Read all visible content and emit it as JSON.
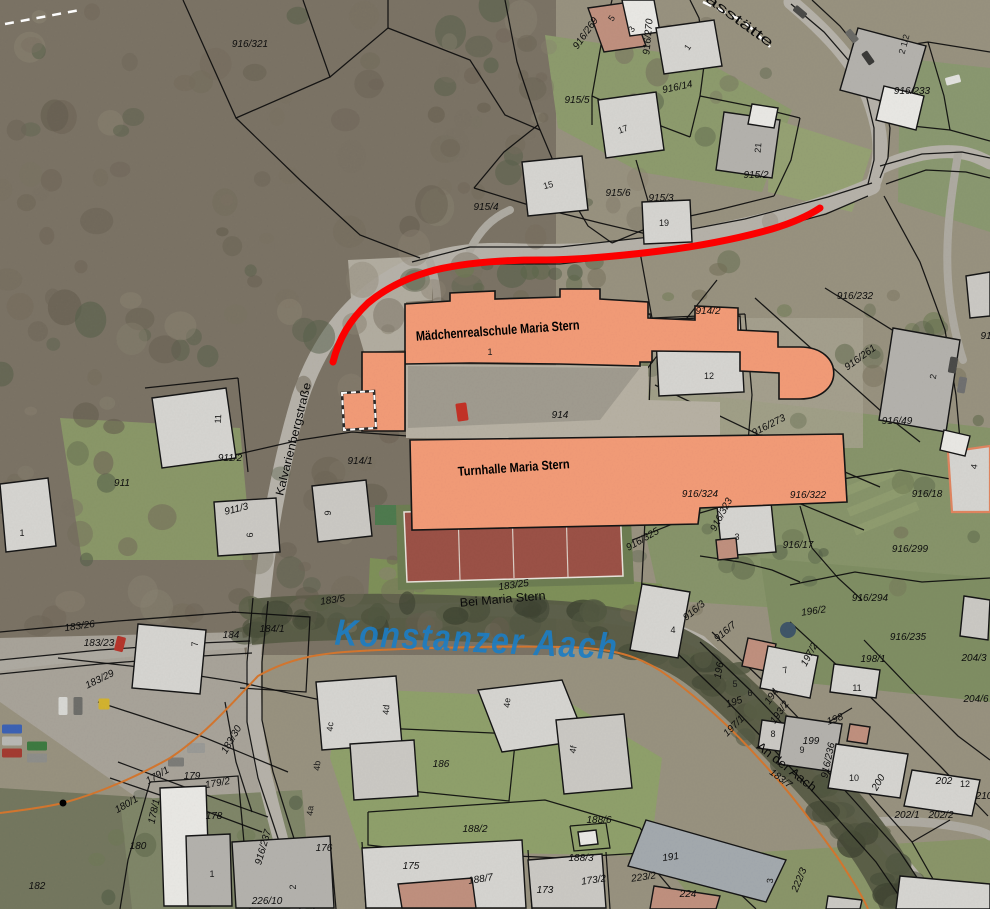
{
  "map": {
    "school_label": "Mädchenrealschule Maria Stern",
    "turnhalle_label": "Turnhalle Maria Stern",
    "water_label": "Konstanzer Aach",
    "colors": {
      "highlight": "#F29B77",
      "route": "#FE0000",
      "water_text": "#1D7EC5",
      "orange_boundary": "#D4762E"
    },
    "street_labels": [
      {
        "t": "Kalvarienbergstraße",
        "x": 297,
        "y": 440,
        "r": -76,
        "s": 11.5,
        "len": 116
      },
      {
        "t": "Bei Maria Stern",
        "x": 503,
        "y": 603,
        "r": -5,
        "s": 12,
        "len": 86
      },
      {
        "t": "An der Aach",
        "x": 784,
        "y": 770,
        "r": 38,
        "s": 12.5,
        "len": 72
      },
      {
        "t": "asstätte",
        "x": 737,
        "y": 24,
        "r": 36,
        "s": 13.5,
        "len": 80
      }
    ],
    "parcel_labels": [
      {
        "t": "916/321",
        "x": 250,
        "y": 47
      },
      {
        "t": "916/269",
        "x": 588,
        "y": 35,
        "r": -55
      },
      {
        "t": "916/270",
        "x": 651,
        "y": 37,
        "r": -85
      },
      {
        "t": "916/14",
        "x": 678,
        "y": 90,
        "r": -12
      },
      {
        "t": "915/5",
        "x": 577,
        "y": 103
      },
      {
        "t": "915/4",
        "x": 486,
        "y": 210
      },
      {
        "t": "915/6",
        "x": 618,
        "y": 196
      },
      {
        "t": "915/3",
        "x": 661,
        "y": 201
      },
      {
        "t": "915/2",
        "x": 756,
        "y": 178
      },
      {
        "t": "916/233",
        "x": 912,
        "y": 94
      },
      {
        "t": "916/232",
        "x": 855,
        "y": 299
      },
      {
        "t": "914/2",
        "x": 708,
        "y": 314
      },
      {
        "t": "916/261",
        "x": 862,
        "y": 360,
        "r": -36
      },
      {
        "t": "916/273",
        "x": 770,
        "y": 428,
        "r": -27
      },
      {
        "t": "916/49",
        "x": 897,
        "y": 424
      },
      {
        "t": "914",
        "x": 560,
        "y": 418
      },
      {
        "t": "914/1",
        "x": 360,
        "y": 464
      },
      {
        "t": "911/2",
        "x": 230,
        "y": 461
      },
      {
        "t": "911",
        "x": 122,
        "y": 486
      },
      {
        "t": "911/3",
        "x": 237,
        "y": 512,
        "r": -14
      },
      {
        "t": "916/324",
        "x": 700,
        "y": 497
      },
      {
        "t": "916/323",
        "x": 724,
        "y": 516,
        "r": -62
      },
      {
        "t": "916/322",
        "x": 808,
        "y": 498
      },
      {
        "t": "916/325",
        "x": 644,
        "y": 542,
        "r": -30
      },
      {
        "t": "916/17",
        "x": 798,
        "y": 548
      },
      {
        "t": "916/18",
        "x": 927,
        "y": 497
      },
      {
        "t": "916/299",
        "x": 910,
        "y": 552
      },
      {
        "t": "916/3",
        "x": 696,
        "y": 613,
        "r": -40
      },
      {
        "t": "916/7",
        "x": 727,
        "y": 634,
        "r": -40
      },
      {
        "t": "196/2",
        "x": 814,
        "y": 614,
        "r": -8
      },
      {
        "t": "916/294",
        "x": 870,
        "y": 601
      },
      {
        "t": "916/235",
        "x": 908,
        "y": 640
      },
      {
        "t": "198/1",
        "x": 873,
        "y": 662
      },
      {
        "t": "204/3",
        "x": 974,
        "y": 661
      },
      {
        "t": "204/6",
        "x": 976,
        "y": 702
      },
      {
        "t": "197/2",
        "x": 812,
        "y": 656,
        "r": -62
      },
      {
        "t": "196",
        "x": 722,
        "y": 671,
        "r": -80
      },
      {
        "t": "195",
        "x": 735,
        "y": 705,
        "r": -18
      },
      {
        "t": "194",
        "x": 774,
        "y": 698,
        "r": -55
      },
      {
        "t": "193/2",
        "x": 782,
        "y": 714,
        "r": -55
      },
      {
        "t": "197/1",
        "x": 736,
        "y": 728,
        "r": -45
      },
      {
        "t": "183/7",
        "x": 779,
        "y": 781,
        "r": 36
      },
      {
        "t": "198",
        "x": 836,
        "y": 722,
        "r": -20
      },
      {
        "t": "199",
        "x": 811,
        "y": 744
      },
      {
        "t": "916/236",
        "x": 831,
        "y": 761,
        "r": -78
      },
      {
        "t": "200",
        "x": 881,
        "y": 784,
        "r": -60
      },
      {
        "t": "202",
        "x": 944,
        "y": 784
      },
      {
        "t": "210",
        "x": 984,
        "y": 799
      },
      {
        "t": "202/1",
        "x": 907,
        "y": 818
      },
      {
        "t": "202/2",
        "x": 941,
        "y": 818
      },
      {
        "t": "183/25",
        "x": 514,
        "y": 588,
        "r": -8
      },
      {
        "t": "183/5",
        "x": 333,
        "y": 603,
        "r": -8
      },
      {
        "t": "183/26",
        "x": 80,
        "y": 629,
        "r": -8
      },
      {
        "t": "183/23",
        "x": 99,
        "y": 646
      },
      {
        "t": "183/29",
        "x": 101,
        "y": 682,
        "r": -26
      },
      {
        "t": "184",
        "x": 231,
        "y": 638
      },
      {
        "t": "184/1",
        "x": 272,
        "y": 632
      },
      {
        "t": "183/30",
        "x": 234,
        "y": 741,
        "r": -60
      },
      {
        "t": "179/1",
        "x": 159,
        "y": 778,
        "r": -30
      },
      {
        "t": "179",
        "x": 192,
        "y": 779
      },
      {
        "t": "179/2",
        "x": 218,
        "y": 786,
        "r": -10
      },
      {
        "t": "180/1",
        "x": 128,
        "y": 807,
        "r": -30
      },
      {
        "t": "178/1",
        "x": 157,
        "y": 812,
        "r": -78
      },
      {
        "t": "178",
        "x": 214,
        "y": 819
      },
      {
        "t": "180",
        "x": 138,
        "y": 849
      },
      {
        "t": "182",
        "x": 37,
        "y": 889
      },
      {
        "t": "916/237",
        "x": 266,
        "y": 848,
        "r": -74
      },
      {
        "t": "226/10",
        "x": 267,
        "y": 904
      },
      {
        "t": "176",
        "x": 324,
        "y": 851
      },
      {
        "t": "175",
        "x": 411,
        "y": 869
      },
      {
        "t": "186",
        "x": 441,
        "y": 767
      },
      {
        "t": "188/2",
        "x": 475,
        "y": 832
      },
      {
        "t": "188/6",
        "x": 599,
        "y": 823
      },
      {
        "t": "188/3",
        "x": 581,
        "y": 861
      },
      {
        "t": "188/7",
        "x": 481,
        "y": 882,
        "r": -9
      },
      {
        "t": "173",
        "x": 545,
        "y": 893
      },
      {
        "t": "173/2",
        "x": 594,
        "y": 883,
        "r": -8
      },
      {
        "t": "223/2",
        "x": 644,
        "y": 880,
        "r": -8
      },
      {
        "t": "191",
        "x": 671,
        "y": 860,
        "r": -8
      },
      {
        "t": "224",
        "x": 688,
        "y": 897
      },
      {
        "t": "222/3",
        "x": 802,
        "y": 881,
        "r": -68
      },
      {
        "t": "91",
        "x": 986,
        "y": 339
      }
    ],
    "house_numbers": [
      {
        "t": "5",
        "x": 614,
        "y": 20,
        "r": -55
      },
      {
        "t": "3",
        "x": 634,
        "y": 31,
        "r": -55
      },
      {
        "t": "1",
        "x": 690,
        "y": 49,
        "r": -55
      },
      {
        "t": "17",
        "x": 624,
        "y": 132,
        "r": -20
      },
      {
        "t": "15",
        "x": 549,
        "y": 188,
        "r": -15
      },
      {
        "t": "21",
        "x": 761,
        "y": 148,
        "r": -85
      },
      {
        "t": "19",
        "x": 664,
        "y": 226
      },
      {
        "t": "2 1/2",
        "x": 907,
        "y": 45,
        "r": -75
      },
      {
        "t": "12",
        "x": 709,
        "y": 379
      },
      {
        "t": "2",
        "x": 936,
        "y": 377,
        "r": -80
      },
      {
        "t": "1",
        "x": 490,
        "y": 355
      },
      {
        "t": "11",
        "x": 221,
        "y": 419,
        "r": -87
      },
      {
        "t": "9",
        "x": 331,
        "y": 513,
        "r": -90
      },
      {
        "t": "6",
        "x": 253,
        "y": 535,
        "r": -90
      },
      {
        "t": "1",
        "x": 22,
        "y": 536
      },
      {
        "t": "3",
        "x": 737,
        "y": 540
      },
      {
        "t": "4",
        "x": 977,
        "y": 467,
        "r": -80
      },
      {
        "t": "4",
        "x": 673,
        "y": 633
      },
      {
        "t": "7",
        "x": 786,
        "y": 673,
        "r": -15
      },
      {
        "t": "7",
        "x": 198,
        "y": 644,
        "r": -90
      },
      {
        "t": "5",
        "x": 735,
        "y": 687
      },
      {
        "t": "6",
        "x": 750,
        "y": 696
      },
      {
        "t": "8",
        "x": 773,
        "y": 737
      },
      {
        "t": "9",
        "x": 802,
        "y": 753
      },
      {
        "t": "10",
        "x": 854,
        "y": 781
      },
      {
        "t": "11",
        "x": 857,
        "y": 691
      },
      {
        "t": "12",
        "x": 965,
        "y": 787
      },
      {
        "t": "3",
        "x": 773,
        "y": 881,
        "r": -85
      },
      {
        "t": "1",
        "x": 212,
        "y": 877
      },
      {
        "t": "2",
        "x": 296,
        "y": 887,
        "r": -90
      },
      {
        "t": "4a",
        "x": 313,
        "y": 811,
        "r": -85
      },
      {
        "t": "4b",
        "x": 320,
        "y": 766,
        "r": -85
      },
      {
        "t": "4c",
        "x": 333,
        "y": 727,
        "r": -85
      },
      {
        "t": "4d",
        "x": 389,
        "y": 710,
        "r": -85
      },
      {
        "t": "4e",
        "x": 510,
        "y": 703,
        "r": -85
      },
      {
        "t": "4f",
        "x": 576,
        "y": 750,
        "r": -80
      }
    ]
  }
}
